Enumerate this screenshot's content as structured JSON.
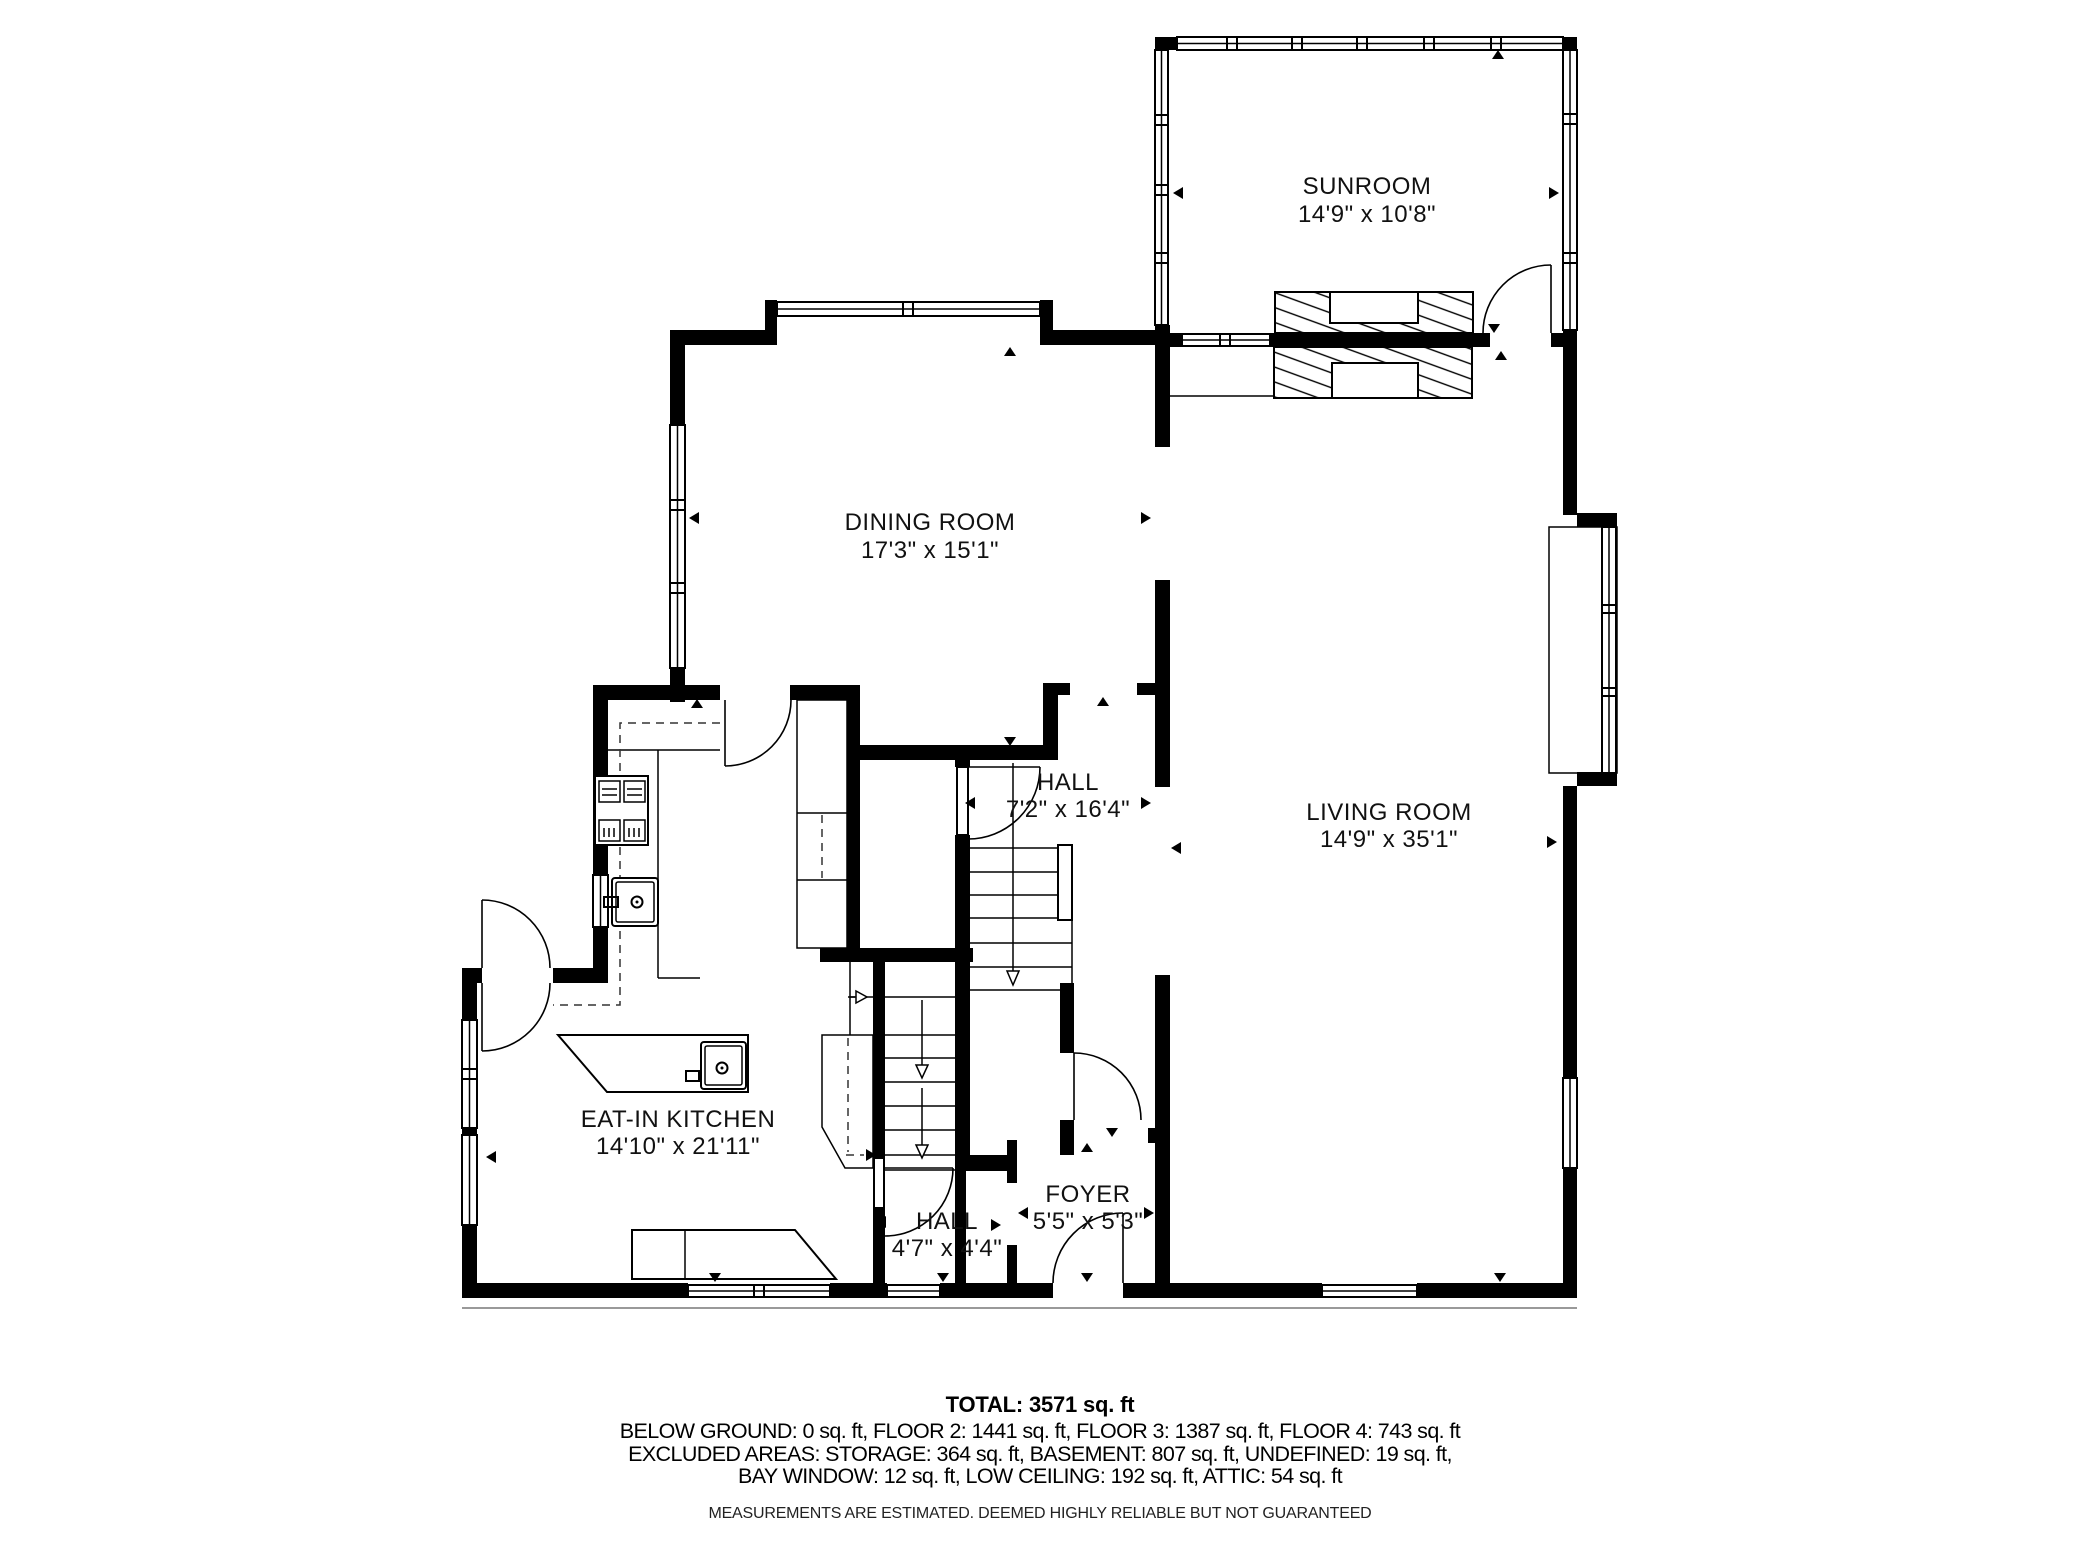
{
  "plan": {
    "rooms": [
      {
        "name": "SUNROOM",
        "dims": "14'9\" x 10'8\""
      },
      {
        "name": "DINING ROOM",
        "dims": "17'3\" x 15'1\""
      },
      {
        "name": "LIVING ROOM",
        "dims": "14'9\" x 35'1\""
      },
      {
        "name": "HALL",
        "dims": "7'2\" x 16'4\""
      },
      {
        "name": "EAT-IN KITCHEN",
        "dims": "14'10\" x 21'11\""
      },
      {
        "name": "HALL",
        "dims": "4'7\" x 4'4\""
      },
      {
        "name": "FOYER",
        "dims": "5'5\" x 5'3\""
      }
    ]
  },
  "summary": {
    "total": "TOTAL: 3571 sq. ft",
    "floors": "BELOW GROUND: 0 sq. ft, FLOOR 2: 1441 sq. ft, FLOOR 3: 1387 sq. ft, FLOOR 4: 743 sq. ft",
    "excluded_1": "EXCLUDED AREAS: STORAGE: 364 sq. ft, BASEMENT: 807 sq. ft, UNDEFINED: 19 sq. ft,",
    "excluded_2": "BAY WINDOW: 12 sq. ft, LOW CEILING: 192 sq. ft, ATTIC: 54 sq. ft",
    "disclaimer": "MEASUREMENTS ARE ESTIMATED. DEEMED HIGHLY RELIABLE BUT NOT GUARANTEED"
  }
}
